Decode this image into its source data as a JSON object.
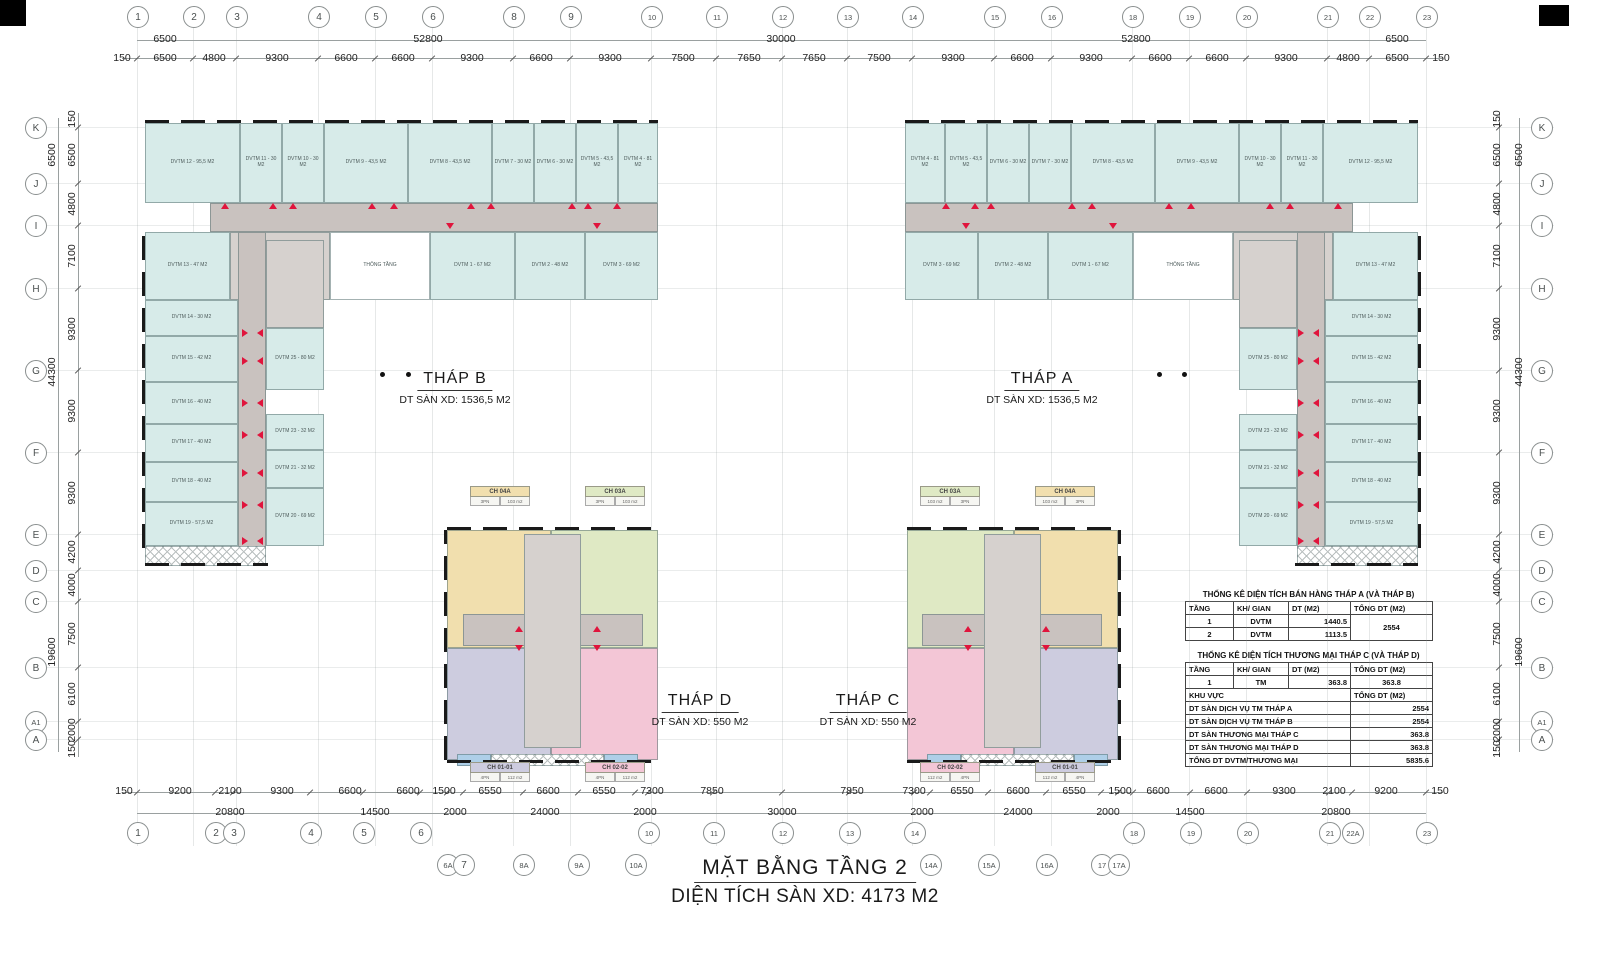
{
  "colors": {
    "accent_red": "#e0143c",
    "room_cyan": "#d7ebe9",
    "corridor_gray": "#c9c2bf",
    "tan": "#f1dfae",
    "green": "#dfe9c4",
    "lavender": "#cdccdf",
    "pink": "#f3c6d6",
    "balcony_blue": "#aecfe8",
    "wall_black": "#1a1a1a"
  },
  "title": {
    "line1": "MẶT BẰNG TẦNG 2",
    "line2": "DIỆN TÍCH SÀN XD: 4173 M2"
  },
  "grid": {
    "top_circles": [
      {
        "t": "1",
        "x": 137
      },
      {
        "t": "2",
        "x": 193
      },
      {
        "t": "3",
        "x": 236
      },
      {
        "t": "4",
        "x": 318
      },
      {
        "t": "5",
        "x": 375
      },
      {
        "t": "6",
        "x": 432
      },
      {
        "t": "8",
        "x": 513
      },
      {
        "t": "9",
        "x": 570
      },
      {
        "t": "10",
        "x": 651
      },
      {
        "t": "11",
        "x": 716
      },
      {
        "t": "12",
        "x": 782
      },
      {
        "t": "13",
        "x": 847
      },
      {
        "t": "14",
        "x": 912
      },
      {
        "t": "15",
        "x": 994
      },
      {
        "t": "16",
        "x": 1051
      },
      {
        "t": "18",
        "x": 1132
      },
      {
        "t": "19",
        "x": 1189
      },
      {
        "t": "20",
        "x": 1246
      },
      {
        "t": "21",
        "x": 1327
      },
      {
        "t": "22",
        "x": 1369
      },
      {
        "t": "23",
        "x": 1426
      }
    ],
    "bottom_circles": [
      {
        "t": "1",
        "x": 137
      },
      {
        "t": "2",
        "x": 215
      },
      {
        "t": "3",
        "x": 233
      },
      {
        "t": "4",
        "x": 310
      },
      {
        "t": "5",
        "x": 363
      },
      {
        "t": "6",
        "x": 420
      },
      {
        "t": "10",
        "x": 648
      },
      {
        "t": "11",
        "x": 713
      },
      {
        "t": "12",
        "x": 782
      },
      {
        "t": "13",
        "x": 849
      },
      {
        "t": "14",
        "x": 914
      },
      {
        "t": "18",
        "x": 1133
      },
      {
        "t": "19",
        "x": 1190
      },
      {
        "t": "20",
        "x": 1247
      },
      {
        "t": "21",
        "x": 1329
      },
      {
        "t": "22A",
        "x": 1352
      },
      {
        "t": "23",
        "x": 1426
      }
    ],
    "bottom_circles2": [
      {
        "t": "6A",
        "x": 447
      },
      {
        "t": "7",
        "x": 463
      },
      {
        "t": "8A",
        "x": 523
      },
      {
        "t": "9A",
        "x": 578
      },
      {
        "t": "10A",
        "x": 635
      },
      {
        "t": "14A",
        "x": 930
      },
      {
        "t": "15A",
        "x": 988
      },
      {
        "t": "16A",
        "x": 1046
      },
      {
        "t": "17",
        "x": 1101
      },
      {
        "t": "17A",
        "x": 1118
      }
    ],
    "side_circles": [
      {
        "t": "K",
        "y": 127
      },
      {
        "t": "J",
        "y": 183
      },
      {
        "t": "I",
        "y": 225
      },
      {
        "t": "H",
        "y": 288
      },
      {
        "t": "G",
        "y": 370
      },
      {
        "t": "F",
        "y": 452
      },
      {
        "t": "E",
        "y": 534
      },
      {
        "t": "D",
        "y": 570
      },
      {
        "t": "C",
        "y": 601
      },
      {
        "t": "B",
        "y": 667
      },
      {
        "t": "A1",
        "y": 721
      },
      {
        "t": "A",
        "y": 739
      }
    ],
    "dim_rows": [
      {
        "y": 33,
        "labels": [
          [
            "6500",
            165
          ],
          [
            "52800",
            428
          ],
          [
            "30000",
            781
          ],
          [
            "52800",
            1136
          ],
          [
            "6500",
            1397
          ]
        ]
      },
      {
        "y": 52,
        "labels": [
          [
            "150",
            122
          ],
          [
            "6500",
            165
          ],
          [
            "4800",
            214
          ],
          [
            "9300",
            277
          ],
          [
            "6600",
            346
          ],
          [
            "6600",
            403
          ],
          [
            "9300",
            472
          ],
          [
            "6600",
            541
          ],
          [
            "9300",
            610
          ],
          [
            "7500",
            683
          ],
          [
            "7650",
            749
          ],
          [
            "7650",
            814
          ],
          [
            "7500",
            879
          ],
          [
            "9300",
            953
          ],
          [
            "6600",
            1022
          ],
          [
            "9300",
            1091
          ],
          [
            "6600",
            1160
          ],
          [
            "6600",
            1217
          ],
          [
            "9300",
            1286
          ],
          [
            "4800",
            1348
          ],
          [
            "6500",
            1397
          ],
          [
            "150",
            1441
          ]
        ]
      },
      {
        "y": 785,
        "labels": [
          [
            "150",
            124
          ],
          [
            "9200",
            180
          ],
          [
            "2100",
            230
          ],
          [
            "9300",
            282
          ],
          [
            "6600",
            350
          ],
          [
            "6600",
            408
          ],
          [
            "1500",
            444
          ],
          [
            "6550",
            490
          ],
          [
            "6600",
            548
          ],
          [
            "6550",
            604
          ],
          [
            "7300",
            652
          ],
          [
            "7850",
            712
          ],
          [
            "7850",
            852
          ],
          [
            "7300",
            914
          ],
          [
            "6550",
            962
          ],
          [
            "6600",
            1018
          ],
          [
            "6550",
            1074
          ],
          [
            "1500",
            1120
          ],
          [
            "6600",
            1158
          ],
          [
            "6600",
            1216
          ],
          [
            "9300",
            1284
          ],
          [
            "2100",
            1334
          ],
          [
            "9200",
            1386
          ],
          [
            "150",
            1440
          ]
        ]
      },
      {
        "y": 806,
        "labels": [
          [
            "20800",
            230
          ],
          [
            "14500",
            375
          ],
          [
            "2000",
            455
          ],
          [
            "24000",
            545
          ],
          [
            "2000",
            645
          ],
          [
            "30000",
            782
          ],
          [
            "2000",
            922
          ],
          [
            "24000",
            1018
          ],
          [
            "2000",
            1108
          ],
          [
            "14500",
            1190
          ],
          [
            "20800",
            1336
          ]
        ]
      }
    ],
    "side_inner": [
      [
        "150",
        119
      ],
      [
        "6500",
        155
      ],
      [
        "4800",
        204
      ],
      [
        "7100",
        256
      ],
      [
        "9300",
        329
      ],
      [
        "9300",
        411
      ],
      [
        "9300",
        493
      ],
      [
        "4200",
        552
      ],
      [
        "4000",
        585
      ],
      [
        "7500",
        634
      ],
      [
        "6100",
        694
      ],
      [
        "2000",
        730
      ],
      [
        "150",
        749
      ]
    ],
    "side_outer": [
      [
        "6500",
        155
      ],
      [
        "44300",
        372
      ],
      [
        "19600",
        652
      ]
    ],
    "side_x": {
      "left_inner": 72,
      "left_outer": 52,
      "right_inner": 1497,
      "right_outer": 1519,
      "left_circle": 35,
      "right_circle": 1541
    }
  },
  "mirror": {
    "towers": 1563,
    "blocks": 1565
  },
  "towers": {
    "labels": [
      {
        "name": "THÁP B",
        "area": "DT SÀN XD: 1536,5 M2",
        "x": 455,
        "y": 370
      },
      {
        "name": "THÁP A",
        "area": "DT SÀN XD: 1536,5 M2",
        "x": 1042,
        "y": 370
      },
      {
        "name": "THÁP D",
        "area": "DT SÀN XD: 550 M2",
        "x": 700,
        "y": 692
      },
      {
        "name": "THÁP C",
        "area": "DT SÀN XD: 550 M2",
        "x": 868,
        "y": 692
      }
    ],
    "dots": [
      [
        380,
        372
      ],
      [
        406,
        372
      ],
      [
        1157,
        372
      ],
      [
        1182,
        372
      ]
    ],
    "rooms": [
      {
        "x": 145,
        "y": 123,
        "w": 95,
        "h": 80,
        "c": "cy",
        "t": "DVTM 12 - 95,5 M2"
      },
      {
        "x": 240,
        "y": 123,
        "w": 42,
        "h": 80,
        "c": "cy",
        "t": "DVTM 11 - 30 M2"
      },
      {
        "x": 282,
        "y": 123,
        "w": 42,
        "h": 80,
        "c": "cy",
        "t": "DVTM 10 - 30 M2"
      },
      {
        "x": 324,
        "y": 123,
        "w": 84,
        "h": 80,
        "c": "cy",
        "t": "DVTM 9 - 43,5 M2"
      },
      {
        "x": 408,
        "y": 123,
        "w": 84,
        "h": 80,
        "c": "cy",
        "t": "DVTM 8 - 43,5 M2"
      },
      {
        "x": 492,
        "y": 123,
        "w": 42,
        "h": 80,
        "c": "cy",
        "t": "DVTM 7 - 30 M2"
      },
      {
        "x": 534,
        "y": 123,
        "w": 42,
        "h": 80,
        "c": "cy",
        "t": "DVTM 6 - 30 M2"
      },
      {
        "x": 576,
        "y": 123,
        "w": 42,
        "h": 80,
        "c": "cy",
        "t": "DVTM 5 - 43,5 M2"
      },
      {
        "x": 618,
        "y": 123,
        "w": 40,
        "h": 80,
        "c": "cy",
        "t": "DVTM 4 - 81 M2"
      },
      {
        "x": 210,
        "y": 203,
        "w": 448,
        "h": 29,
        "c": "g1",
        "t": ""
      },
      {
        "x": 145,
        "y": 232,
        "w": 85,
        "h": 68,
        "c": "cy",
        "t": "DVTM 13 - 47 M2"
      },
      {
        "x": 230,
        "y": 232,
        "w": 100,
        "h": 68,
        "c": "g2",
        "t": "SẢNH TẦNG"
      },
      {
        "x": 330,
        "y": 232,
        "w": 100,
        "h": 68,
        "c": "wh",
        "t": "THÔNG TẦNG"
      },
      {
        "x": 430,
        "y": 232,
        "w": 85,
        "h": 68,
        "c": "cy",
        "t": "DVTM 1 - 67 M2"
      },
      {
        "x": 515,
        "y": 232,
        "w": 70,
        "h": 68,
        "c": "cy",
        "t": "DVTM 2 - 48 M2"
      },
      {
        "x": 585,
        "y": 232,
        "w": 73,
        "h": 68,
        "c": "cy",
        "t": "DVTM 3 - 69 M2"
      },
      {
        "x": 145,
        "y": 300,
        "w": 93,
        "h": 36,
        "c": "cy",
        "t": "DVTM 14 - 30 M2"
      },
      {
        "x": 145,
        "y": 336,
        "w": 93,
        "h": 46,
        "c": "cy",
        "t": "DVTM 15 - 42 M2"
      },
      {
        "x": 145,
        "y": 382,
        "w": 93,
        "h": 42,
        "c": "cy",
        "t": "DVTM 16 - 40 M2"
      },
      {
        "x": 145,
        "y": 424,
        "w": 93,
        "h": 38,
        "c": "cy",
        "t": "DVTM 17 - 40 M2"
      },
      {
        "x": 145,
        "y": 462,
        "w": 93,
        "h": 40,
        "c": "cy",
        "t": "DVTM 18 - 40 M2"
      },
      {
        "x": 145,
        "y": 502,
        "w": 93,
        "h": 44,
        "c": "cy",
        "t": "DVTM 19 - 57,5 M2"
      },
      {
        "x": 238,
        "y": 232,
        "w": 28,
        "h": 316,
        "c": "g1",
        "t": ""
      },
      {
        "x": 266,
        "y": 240,
        "w": 58,
        "h": 88,
        "c": "g2",
        "t": ""
      },
      {
        "x": 266,
        "y": 328,
        "w": 58,
        "h": 62,
        "c": "cy",
        "t": "DVTM 25 - 80 M2"
      },
      {
        "x": 266,
        "y": 414,
        "w": 58,
        "h": 36,
        "c": "cy",
        "t": "DVTM 23 - 32 M2"
      },
      {
        "x": 266,
        "y": 450,
        "w": 58,
        "h": 38,
        "c": "cy",
        "t": "DVTM 21 - 32 M2"
      },
      {
        "x": 266,
        "y": 488,
        "w": 58,
        "h": 58,
        "c": "cy",
        "t": "DVTM 20 - 69 M2"
      },
      {
        "x": 145,
        "y": 546,
        "w": 121,
        "h": 20,
        "c": "ht",
        "t": ""
      }
    ],
    "triangles": [
      [
        "u",
        225,
        206
      ],
      [
        "u",
        273,
        206
      ],
      [
        "u",
        293,
        206
      ],
      [
        "u",
        372,
        206
      ],
      [
        "u",
        394,
        206
      ],
      [
        "u",
        471,
        206
      ],
      [
        "u",
        491,
        206
      ],
      [
        "u",
        572,
        206
      ],
      [
        "u",
        588,
        206
      ],
      [
        "u",
        617,
        206
      ],
      [
        "d",
        450,
        226
      ],
      [
        "d",
        597,
        226
      ],
      [
        "r",
        246,
        332
      ],
      [
        "l",
        261,
        332
      ],
      [
        "r",
        246,
        360
      ],
      [
        "l",
        261,
        360
      ],
      [
        "r",
        246,
        402
      ],
      [
        "l",
        261,
        402
      ],
      [
        "r",
        246,
        434
      ],
      [
        "l",
        261,
        434
      ],
      [
        "r",
        246,
        472
      ],
      [
        "l",
        261,
        472
      ],
      [
        "r",
        246,
        504
      ],
      [
        "l",
        261,
        504
      ],
      [
        "r",
        246,
        540
      ],
      [
        "l",
        261,
        540
      ]
    ]
  },
  "blocks": {
    "parts": [
      {
        "x": 447,
        "y": 530,
        "w": 104,
        "h": 118,
        "c": "tan",
        "t": ""
      },
      {
        "x": 551,
        "y": 530,
        "w": 107,
        "h": 118,
        "c": "grn",
        "t": ""
      },
      {
        "x": 447,
        "y": 648,
        "w": 104,
        "h": 112,
        "c": "lav",
        "t": ""
      },
      {
        "x": 551,
        "y": 648,
        "w": 107,
        "h": 112,
        "c": "pnk",
        "t": ""
      },
      {
        "x": 463,
        "y": 614,
        "w": 180,
        "h": 32,
        "c": "g1",
        "t": ""
      },
      {
        "x": 524,
        "y": 534,
        "w": 57,
        "h": 214,
        "c": "g2",
        "t": ""
      },
      {
        "x": 457,
        "y": 754,
        "w": 34,
        "h": 12,
        "c": "blu",
        "t": ""
      },
      {
        "x": 604,
        "y": 754,
        "w": 34,
        "h": 12,
        "c": "blu",
        "t": ""
      },
      {
        "x": 491,
        "y": 754,
        "w": 113,
        "h": 12,
        "c": "ht",
        "t": ""
      }
    ],
    "triangles": [
      [
        "u",
        519,
        629
      ],
      [
        "u",
        597,
        629
      ],
      [
        "d",
        519,
        648
      ],
      [
        "d",
        597,
        648
      ]
    ],
    "tags": [
      {
        "x": 470,
        "y": 486,
        "head": "CH 04A",
        "hc": "tan",
        "cells": [
          "3PN",
          "103 m2"
        ]
      },
      {
        "x": 585,
        "y": 486,
        "head": "CH 03A",
        "hc": "grn",
        "cells": [
          "3PN",
          "103 m2"
        ]
      },
      {
        "x": 470,
        "y": 762,
        "head": "CH 01-01",
        "hc": "lav",
        "cells": [
          "4PN",
          "112 m2"
        ]
      },
      {
        "x": 585,
        "y": 762,
        "head": "CH 02-02",
        "hc": "pnk",
        "cells": [
          "4PN",
          "112 m2"
        ]
      },
      {
        "x": 920,
        "y": 486,
        "head": "CH 03A",
        "hc": "grn",
        "cells": [
          "103 m2",
          "3PN"
        ]
      },
      {
        "x": 1035,
        "y": 486,
        "head": "CH 04A",
        "hc": "tan",
        "cells": [
          "103 m2",
          "3PN"
        ]
      },
      {
        "x": 920,
        "y": 762,
        "head": "CH 02-02",
        "hc": "pnk",
        "cells": [
          "112 m2",
          "4PN"
        ]
      },
      {
        "x": 1035,
        "y": 762,
        "head": "CH 01-01",
        "hc": "lav",
        "cells": [
          "112 m2",
          "4PN"
        ]
      }
    ]
  },
  "wall_strips": [
    {
      "x": 145,
      "y": 120,
      "w": 513,
      "h": 3,
      "dir": "h",
      "axis": 1563
    },
    {
      "x": 142,
      "y": 232,
      "w": 3,
      "h": 316,
      "dir": "v",
      "axis": 1563
    },
    {
      "x": 145,
      "y": 563,
      "w": 123,
      "h": 3,
      "dir": "h",
      "axis": 1563
    },
    {
      "x": 447,
      "y": 527,
      "w": 211,
      "h": 3,
      "dir": "h",
      "axis": 1565
    },
    {
      "x": 447,
      "y": 760,
      "w": 211,
      "h": 3,
      "dir": "h",
      "axis": 1565
    },
    {
      "x": 444,
      "y": 530,
      "w": 3,
      "h": 230,
      "dir": "v",
      "axis": 1565
    }
  ],
  "corner_marks": [
    {
      "x": 0,
      "y": 0,
      "w": 26,
      "h": 26
    },
    {
      "x": 1539,
      "y": 5,
      "w": 30,
      "h": 21
    }
  ],
  "tables": {
    "x": 1185,
    "y": 590,
    "t1": {
      "title": "THỐNG KÊ DIỆN TÍCH BÁN HÀNG THÁP A (VÀ THÁP B)",
      "headers": [
        "TẦNG",
        "KH/ GIAN",
        "DT (M2)",
        "TỔNG DT (M2)"
      ],
      "rows": [
        [
          "1",
          "DVTM",
          "1440.5"
        ],
        [
          "2",
          "DVTM",
          "1113.5"
        ]
      ],
      "total": "2554"
    },
    "t2": {
      "title": "THỐNG KÊ DIỆN TÍCH THƯƠNG MẠI THÁP C (VÀ THÁP D)",
      "headers": [
        "TẦNG",
        "KH/ GIAN",
        "DT (M2)",
        "TỔNG DT (M2)"
      ],
      "rows": [
        [
          "1",
          "TM",
          "363.8",
          "363.8"
        ]
      ],
      "sub_headers": [
        "KHU VỰC",
        "TỔNG DT (M2)"
      ],
      "area_rows": [
        [
          "DT SÀN DỊCH VỤ TM THÁP A",
          "2554"
        ],
        [
          "DT SÀN DỊCH VỤ TM THÁP B",
          "2554"
        ],
        [
          "DT SÀN THƯƠNG MẠI THÁP C",
          "363.8"
        ],
        [
          "DT SÀN THƯƠNG MẠI THÁP D",
          "363.8"
        ],
        [
          "TỔNG DT DVTM/THƯƠNG MẠI",
          "5835.6"
        ]
      ]
    }
  }
}
